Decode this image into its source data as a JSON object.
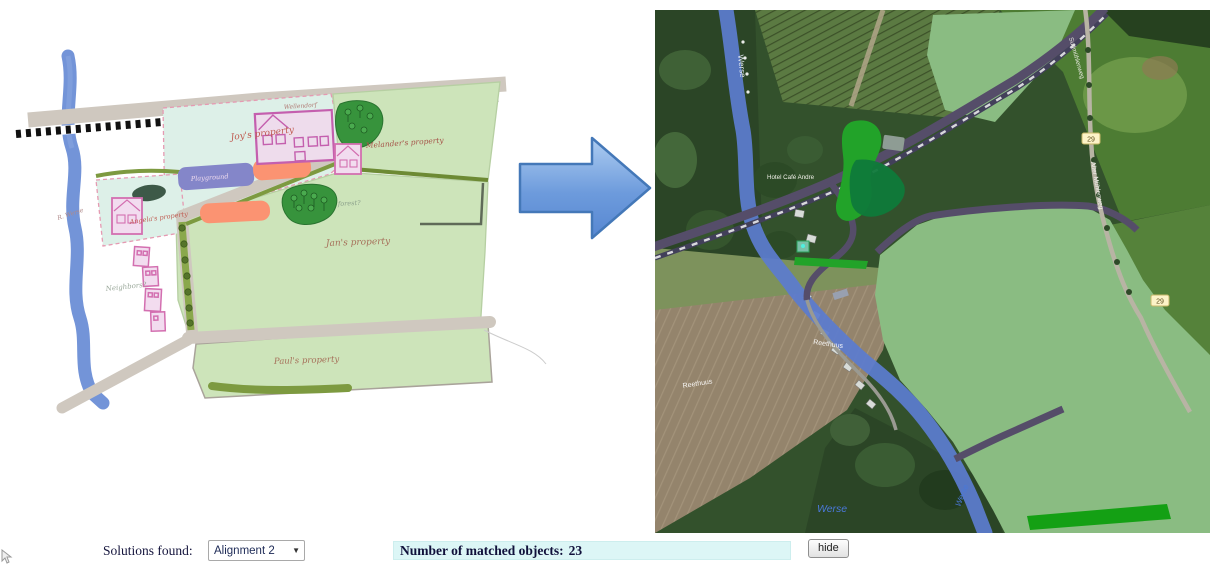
{
  "controls": {
    "solutions_label": "Solutions found:",
    "alignment_value": "Alignment 2",
    "matched_label": "Number of matched objects:",
    "matched_value": "23",
    "hide_button": "hide"
  },
  "sketch": {
    "river_label": "R. Werse",
    "properties": {
      "joy": "Joy's property",
      "melander": "Melander's property",
      "angela": "Angela's property",
      "jan": "Jan's property",
      "paul": "Paul's property"
    },
    "labels": {
      "wellendorf": "Wellendorf",
      "playground": "Playground",
      "forest": "forest?",
      "neighbors": "Neighbors?"
    },
    "colors": {
      "field_green": "#cde4ba",
      "parcel_cyan": "#ddf0e8",
      "river_blue": "#6b8ed6",
      "house_pink": "#cf63b0",
      "orange_patch": "#fb9372",
      "playground_purple": "#8486c9",
      "handwriting_red": "#bf5a50"
    }
  },
  "map": {
    "labels": {
      "river_top": "Werse",
      "cafe": "Hotel Café Andre",
      "road_small_1": "Reethuus",
      "road_small_2": "Reethuus",
      "river_bottom": "Werse",
      "river_bottom_vertical": "Werse",
      "road_right": "Alter Mühlenweg",
      "road_topright": "Sudmühlenweg",
      "badge_1": "29",
      "badge_2": "29"
    },
    "colors": {
      "overlay_field": "#8abc82",
      "overlay_bright_green": "#22a329",
      "overlay_dark_green": "#0f7a3a",
      "river_overlay": "#5b7ccf",
      "road_overlay": "#554d69",
      "badge_yellow": "#fdf3c8"
    }
  },
  "arrow": {
    "fill_top": "#aecdf1",
    "fill_bottom": "#5787d2",
    "stroke": "#4478b8"
  }
}
